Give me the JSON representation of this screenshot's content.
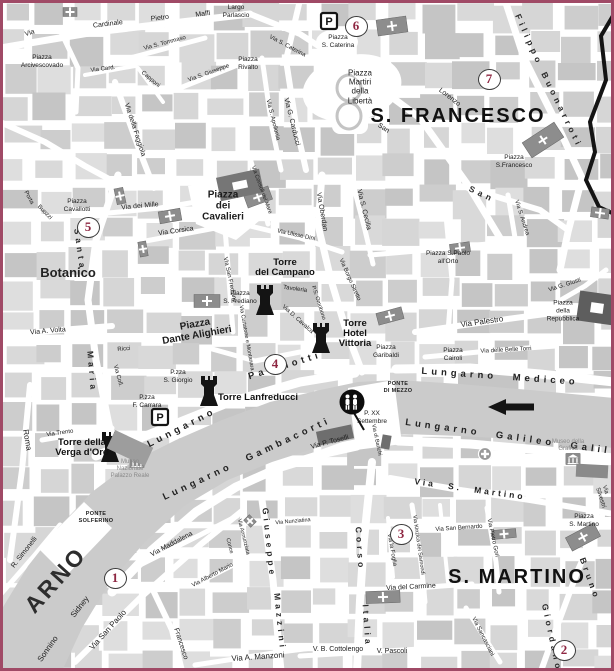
{
  "map": {
    "border_color": "#a04a66",
    "river": {
      "name": "ARNO",
      "flow_direction": "left"
    },
    "districts": [
      "S. FRANCESCO",
      "S. MARTINO",
      "Botanico"
    ],
    "bridges": [
      "PONTE DI MEZZO",
      "PONTE SOLFERINO"
    ],
    "markers": [
      {
        "number": "1",
        "x": 115,
        "y": 578
      },
      {
        "number": "2",
        "x": 564,
        "y": 650
      },
      {
        "number": "3",
        "x": 401,
        "y": 534
      },
      {
        "number": "4",
        "x": 275,
        "y": 364
      },
      {
        "number": "5",
        "x": 88,
        "y": 227
      },
      {
        "number": "6",
        "x": 356,
        "y": 26
      },
      {
        "number": "7",
        "x": 489,
        "y": 79
      }
    ],
    "labels": [
      {
        "t": "Via",
        "x": 30,
        "y": 34,
        "r": -18,
        "c": "s"
      },
      {
        "t": "Cardinale",
        "x": 108,
        "y": 25,
        "r": -7,
        "c": "s"
      },
      {
        "t": "Pietro",
        "x": 160,
        "y": 19,
        "r": -7,
        "c": "s"
      },
      {
        "t": "Maffi",
        "x": 203,
        "y": 15,
        "r": -7,
        "c": "s"
      },
      {
        "t": "Largo\nParlascio",
        "x": 236,
        "y": 12,
        "r": 0,
        "c": "P"
      },
      {
        "t": "Piazza\nArcivescovado",
        "x": 42,
        "y": 62,
        "r": 0,
        "c": "P"
      },
      {
        "t": "Via S. Tommaso",
        "x": 165,
        "y": 44,
        "r": -15,
        "c": "s6"
      },
      {
        "t": "Via Card.",
        "x": 103,
        "y": 70,
        "r": -7,
        "c": "s6"
      },
      {
        "t": "Capponi",
        "x": 150,
        "y": 80,
        "r": 40,
        "c": "s6"
      },
      {
        "t": "Via S. Giuseppe",
        "x": 209,
        "y": 74,
        "r": -20,
        "c": "s6"
      },
      {
        "t": "Piazza\nRivalto",
        "x": 248,
        "y": 64,
        "r": 0,
        "c": "P"
      },
      {
        "t": "Via S. Caterina",
        "x": 287,
        "y": 47,
        "r": 28,
        "c": "s6"
      },
      {
        "t": "Piazza\nS. Caterina",
        "x": 338,
        "y": 42,
        "r": 0,
        "c": "P"
      },
      {
        "t": "Via G. Carducci",
        "x": 291,
        "y": 122,
        "r": 76,
        "c": "s"
      },
      {
        "t": "Via della Faggiola",
        "x": 134,
        "y": 130,
        "r": 72,
        "c": "s"
      },
      {
        "t": "Via S. Apollonia",
        "x": 272,
        "y": 120,
        "r": 76,
        "c": "s6"
      },
      {
        "t": "Filippo",
        "x": 529,
        "y": 40,
        "r": 66,
        "c": "spv"
      },
      {
        "t": "Buonarroti",
        "x": 562,
        "y": 110,
        "r": 64,
        "c": "spv"
      },
      {
        "t": "Piazza\nMartiri\ndella\nLibertà",
        "x": 360,
        "y": 87,
        "r": 0,
        "c": "P8"
      },
      {
        "t": "S. FRANCESCO",
        "x": 458,
        "y": 116,
        "r": 0,
        "c": "d"
      },
      {
        "t": "Lorenzo",
        "x": 449,
        "y": 98,
        "r": 38,
        "c": "s"
      },
      {
        "t": "San",
        "x": 383,
        "y": 129,
        "r": 33,
        "c": "s"
      },
      {
        "t": "Piazza\nS.Francesco",
        "x": 514,
        "y": 162,
        "r": 0,
        "c": "P"
      },
      {
        "t": "Piazza\nCavallotti",
        "x": 77,
        "y": 206,
        "r": 0,
        "c": "P"
      },
      {
        "t": "Via dei Mille",
        "x": 140,
        "y": 207,
        "r": -5,
        "c": "s"
      },
      {
        "t": "Santa",
        "x": 80,
        "y": 250,
        "r": 82,
        "c": "spv"
      },
      {
        "t": "Maria",
        "x": 92,
        "y": 372,
        "r": 85,
        "c": "spv"
      },
      {
        "t": "Via Corsica",
        "x": 176,
        "y": 232,
        "r": -8,
        "c": "s"
      },
      {
        "t": "Piazza\ndei\nCavalieri",
        "x": 223,
        "y": 206,
        "r": 0,
        "c": "PB"
      },
      {
        "t": "Via Consoli del Mare",
        "x": 261,
        "y": 190,
        "r": 70,
        "c": "s5"
      },
      {
        "t": "Via Ulisse Dini",
        "x": 296,
        "y": 236,
        "r": 12,
        "c": "s6"
      },
      {
        "t": "Botanico",
        "x": 68,
        "y": 273,
        "r": 0,
        "c": "D2"
      },
      {
        "t": "Via San Frediano",
        "x": 229,
        "y": 280,
        "r": 78,
        "c": "s6"
      },
      {
        "t": "Piazza\nS. Frediano",
        "x": 240,
        "y": 298,
        "r": 0,
        "c": "P"
      },
      {
        "t": "Torre\ndel Campano",
        "x": 285,
        "y": 268,
        "r": 0,
        "c": "TB"
      },
      {
        "t": "Tavoleria",
        "x": 295,
        "y": 290,
        "r": 8,
        "c": "s6"
      },
      {
        "t": "Via D. Cavalca",
        "x": 297,
        "y": 320,
        "r": 42,
        "c": "s6"
      },
      {
        "t": "P.S. Omobono",
        "x": 318,
        "y": 303,
        "r": 72,
        "c": "s5"
      },
      {
        "t": "Via Borgo Stretto",
        "x": 349,
        "y": 280,
        "r": 66,
        "c": "s6"
      },
      {
        "t": "Via Oberdan",
        "x": 321,
        "y": 212,
        "r": 80,
        "c": "s"
      },
      {
        "t": "Via S. Cecilia",
        "x": 363,
        "y": 210,
        "r": 76,
        "c": "s"
      },
      {
        "t": "San",
        "x": 482,
        "y": 194,
        "r": 25,
        "c": "spv"
      },
      {
        "t": "Via S. Andrea",
        "x": 521,
        "y": 218,
        "r": 72,
        "c": "s6"
      },
      {
        "t": "Piazza S.Paolo\nall'Orto",
        "x": 448,
        "y": 258,
        "r": 0,
        "c": "P"
      },
      {
        "t": "Via Palestro",
        "x": 482,
        "y": 322,
        "r": -8,
        "c": "S"
      },
      {
        "t": "Piazza\ndella\nRepubblica",
        "x": 563,
        "y": 311,
        "r": 0,
        "c": "P"
      },
      {
        "t": "Via G. Giusti",
        "x": 565,
        "y": 286,
        "r": -18,
        "c": "s6"
      },
      {
        "t": "Via delle Belle Torri",
        "x": 506,
        "y": 351,
        "r": -3,
        "c": "s6"
      },
      {
        "t": "Piazza\nCairoli",
        "x": 453,
        "y": 355,
        "r": 0,
        "c": "P"
      },
      {
        "t": "Piazza\nGaribaldi",
        "x": 386,
        "y": 352,
        "r": 0,
        "c": "P"
      },
      {
        "t": "Torre\nHotel\nVittoria",
        "x": 355,
        "y": 334,
        "r": 0,
        "c": "TB"
      },
      {
        "t": "Piazza\nDante Alighieri",
        "x": 196,
        "y": 330,
        "r": -10,
        "c": "PB"
      },
      {
        "t": "Via Curtatone e Montanara",
        "x": 246,
        "y": 338,
        "r": 80,
        "c": "s5"
      },
      {
        "t": "Ricci",
        "x": 124,
        "y": 350,
        "r": -5,
        "c": "s6"
      },
      {
        "t": "Via Coll.",
        "x": 117,
        "y": 376,
        "r": 75,
        "c": "s6"
      },
      {
        "t": "P.zza\nS. Giorgio",
        "x": 178,
        "y": 377,
        "r": 0,
        "c": "P"
      },
      {
        "t": "P.zza\nF. Carrara",
        "x": 147,
        "y": 402,
        "r": 0,
        "c": "P"
      },
      {
        "t": "Via A. Volta",
        "x": 48,
        "y": 332,
        "r": -5,
        "c": "s"
      },
      {
        "t": "Porta",
        "x": 28,
        "y": 198,
        "r": 62,
        "c": "s6"
      },
      {
        "t": "Buozzi",
        "x": 44,
        "y": 213,
        "r": 45,
        "c": "s6"
      },
      {
        "t": "Roma",
        "x": 27,
        "y": 440,
        "r": 80,
        "c": "S"
      },
      {
        "t": "Via Trento",
        "x": 60,
        "y": 434,
        "r": -8,
        "c": "s6"
      },
      {
        "t": "Torre della\nVerga d'Oro",
        "x": 82,
        "y": 448,
        "r": 0,
        "c": "TB"
      },
      {
        "t": "Museo\nNazionale\nPalazzo Reale",
        "x": 130,
        "y": 470,
        "r": 0,
        "c": "mut"
      },
      {
        "t": "Lungarno",
        "x": 182,
        "y": 428,
        "r": -27,
        "c": "sp"
      },
      {
        "t": "Pacinotti",
        "x": 285,
        "y": 366,
        "r": -17,
        "c": "sp"
      },
      {
        "t": "Torre Lanfreducci",
        "x": 258,
        "y": 398,
        "r": 0,
        "c": "TB"
      },
      {
        "t": "Lungarno Mediceo",
        "x": 500,
        "y": 377,
        "r": 4,
        "c": "sp"
      },
      {
        "t": "PONTE\nDI MEZZO",
        "x": 398,
        "y": 388,
        "r": 0,
        "c": "Pc"
      },
      {
        "t": "P. XX\nSettembre",
        "x": 372,
        "y": 418,
        "r": 0,
        "c": "P"
      },
      {
        "t": "Via P. Toselli",
        "x": 330,
        "y": 443,
        "r": -15,
        "c": "s"
      },
      {
        "t": "Via di Banchi",
        "x": 376,
        "y": 440,
        "r": 78,
        "c": "s5"
      },
      {
        "t": "Lungarno Gambacorti",
        "x": 247,
        "y": 459,
        "r": -25,
        "c": "sp"
      },
      {
        "t": "Lungarno Galileo Galil",
        "x": 508,
        "y": 437,
        "r": 8,
        "c": "sp"
      },
      {
        "t": "Museo della\nGrafica",
        "x": 568,
        "y": 446,
        "r": 0,
        "c": "mut"
      },
      {
        "t": "Via S. Martino",
        "x": 470,
        "y": 489,
        "r": 8,
        "c": "spS"
      },
      {
        "t": "PONTE\nSOLFERINO",
        "x": 96,
        "y": 518,
        "r": 0,
        "c": "Pc"
      },
      {
        "t": "R. Simonelli",
        "x": 25,
        "y": 553,
        "r": -52,
        "c": "s"
      },
      {
        "t": "ARNO",
        "x": 56,
        "y": 580,
        "r": -48,
        "c": "RIV"
      },
      {
        "t": "Sidney",
        "x": 80,
        "y": 607,
        "r": -52,
        "c": "S"
      },
      {
        "t": "Sonnino",
        "x": 48,
        "y": 649,
        "r": -55,
        "c": "S"
      },
      {
        "t": "Via San Paolo",
        "x": 108,
        "y": 630,
        "r": -48,
        "c": "S"
      },
      {
        "t": "Via Maddalena",
        "x": 172,
        "y": 545,
        "r": -28,
        "c": "s"
      },
      {
        "t": "Via Alberto Mario",
        "x": 213,
        "y": 576,
        "r": -28,
        "c": "s6"
      },
      {
        "t": "Via Nunziatina",
        "x": 293,
        "y": 522,
        "r": -5,
        "c": "s5"
      },
      {
        "t": "Via Annunziata",
        "x": 243,
        "y": 537,
        "r": 76,
        "c": "s5"
      },
      {
        "t": "Conce",
        "x": 229,
        "y": 546,
        "r": 76,
        "c": "s5"
      },
      {
        "t": "Giuseppe",
        "x": 269,
        "y": 543,
        "r": 84,
        "c": "spv"
      },
      {
        "t": "Mazzini",
        "x": 280,
        "y": 622,
        "r": 84,
        "c": "spv"
      },
      {
        "t": "Via A. Manzoni",
        "x": 258,
        "y": 657,
        "r": -4,
        "c": "S"
      },
      {
        "t": "Francesco",
        "x": 180,
        "y": 644,
        "r": 72,
        "c": "s"
      },
      {
        "t": "V. B. Cottolengo",
        "x": 338,
        "y": 650,
        "r": 0,
        "c": "s"
      },
      {
        "t": "V. Pascoli",
        "x": 392,
        "y": 652,
        "r": 0,
        "c": "s"
      },
      {
        "t": "Corso",
        "x": 360,
        "y": 549,
        "r": 86,
        "c": "spv"
      },
      {
        "t": "Italia",
        "x": 367,
        "y": 626,
        "r": 86,
        "c": "spv"
      },
      {
        "t": "Via la Foglia",
        "x": 391,
        "y": 550,
        "r": 80,
        "c": "s6"
      },
      {
        "t": "Via Kinzica dei Sismondi",
        "x": 418,
        "y": 545,
        "r": 82,
        "c": "s5"
      },
      {
        "t": "Via San Bernardo",
        "x": 459,
        "y": 529,
        "r": -4,
        "c": "s6"
      },
      {
        "t": "Via del Carmine",
        "x": 411,
        "y": 588,
        "r": -3,
        "c": "s"
      },
      {
        "t": "Via Pietro Gori",
        "x": 492,
        "y": 538,
        "r": 78,
        "c": "s6"
      },
      {
        "t": "S. MARTINO",
        "x": 517,
        "y": 577,
        "r": 0,
        "c": "d"
      },
      {
        "t": "Piazza\nS. Martino",
        "x": 584,
        "y": 521,
        "r": 0,
        "c": "P"
      },
      {
        "t": "Bruno",
        "x": 590,
        "y": 579,
        "r": 70,
        "c": "spv"
      },
      {
        "t": "Giordano",
        "x": 552,
        "y": 638,
        "r": 78,
        "c": "spv"
      },
      {
        "t": "Via Sancasciani",
        "x": 482,
        "y": 637,
        "r": 63,
        "c": "s6"
      },
      {
        "t": "Via Silvestri",
        "x": 603,
        "y": 497,
        "r": 72,
        "c": "s6"
      }
    ],
    "icons": [
      {
        "type": "parking",
        "x": 329,
        "y": 21
      },
      {
        "type": "parking",
        "x": 160,
        "y": 417
      },
      {
        "type": "pedestrians",
        "x": 352,
        "y": 402
      },
      {
        "type": "hospital-cross",
        "x": 485,
        "y": 454
      },
      {
        "type": "museum",
        "x": 137,
        "y": 462
      },
      {
        "type": "museum",
        "x": 573,
        "y": 459
      },
      {
        "type": "river-flow-arrow",
        "x": 511,
        "y": 407
      },
      {
        "type": "tower",
        "x": 265,
        "y": 300
      },
      {
        "type": "tower",
        "x": 321,
        "y": 338
      },
      {
        "type": "tower",
        "x": 209,
        "y": 391
      },
      {
        "type": "tower",
        "x": 110,
        "y": 447
      },
      {
        "type": "church",
        "x": 392,
        "y": 26,
        "rot": -8,
        "w": 30,
        "h": 16
      },
      {
        "type": "church",
        "x": 70,
        "y": 12,
        "rot": 0,
        "w": 14,
        "h": 9
      },
      {
        "type": "church",
        "x": 258,
        "y": 197,
        "rot": -20,
        "w": 26,
        "h": 14
      },
      {
        "type": "church",
        "x": 170,
        "y": 216,
        "rot": -10,
        "w": 22,
        "h": 12
      },
      {
        "type": "church",
        "x": 120,
        "y": 196,
        "rot": 78,
        "w": 16,
        "h": 9
      },
      {
        "type": "church",
        "x": 143,
        "y": 249,
        "rot": 80,
        "w": 15,
        "h": 8
      },
      {
        "type": "church",
        "x": 207,
        "y": 301,
        "rot": 0,
        "w": 26,
        "h": 13
      },
      {
        "type": "church",
        "x": 390,
        "y": 316,
        "rot": -15,
        "w": 26,
        "h": 12
      },
      {
        "type": "church",
        "x": 460,
        "y": 248,
        "rot": -8,
        "w": 20,
        "h": 10
      },
      {
        "type": "church",
        "x": 543,
        "y": 140,
        "rot": -33,
        "w": 38,
        "h": 18
      },
      {
        "type": "church",
        "x": 383,
        "y": 597,
        "rot": -2,
        "w": 34,
        "h": 12
      },
      {
        "type": "church",
        "x": 504,
        "y": 534,
        "rot": -5,
        "w": 24,
        "h": 9
      },
      {
        "type": "church",
        "x": 583,
        "y": 537,
        "rot": -28,
        "w": 32,
        "h": 15
      },
      {
        "type": "church",
        "x": 600,
        "y": 213,
        "rot": 8,
        "w": 18,
        "h": 10
      },
      {
        "type": "church",
        "x": 250,
        "y": 521,
        "rot": 45,
        "w": 10,
        "h": 8
      },
      {
        "type": "building",
        "x": 240,
        "y": 185,
        "rot": -12,
        "w": 44,
        "h": 24,
        "fill": "#767676",
        "hole": true
      },
      {
        "type": "building",
        "x": 597,
        "y": 308,
        "rot": 8,
        "w": 38,
        "h": 30,
        "fill": "#5e5e5e",
        "hole": true
      },
      {
        "type": "building",
        "x": 592,
        "y": 471,
        "rot": 3,
        "w": 32,
        "h": 13,
        "fill": "#8a8a8a"
      },
      {
        "type": "building",
        "x": 335,
        "y": 435,
        "rot": -12,
        "w": 36,
        "h": 14,
        "fill": "#6e6e6e"
      },
      {
        "type": "building",
        "x": 386,
        "y": 442,
        "rot": 10,
        "w": 9,
        "h": 14,
        "fill": "#6e6e6e"
      },
      {
        "type": "building",
        "x": 130,
        "y": 448,
        "rot": 25,
        "w": 42,
        "h": 20,
        "fill": "#9d9d9d"
      }
    ]
  }
}
